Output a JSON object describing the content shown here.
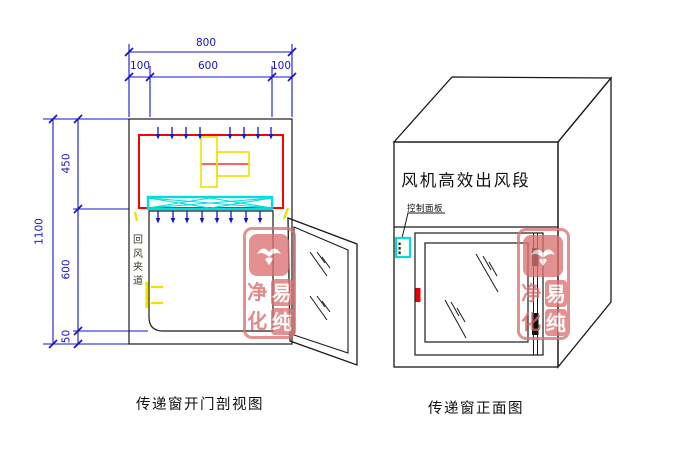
{
  "left_view": {
    "caption": "传递窗开门剖视图",
    "return_air_label": "回风夹道",
    "dimensions": {
      "overall_width": "800",
      "width_left": "100",
      "width_center": "600",
      "width_right": "100",
      "overall_height": "1100",
      "fan_section_height": "450",
      "chamber_height": "600",
      "base_height": "50"
    }
  },
  "right_view": {
    "caption": "传递窗正面图",
    "fan_section_label": "风机高效出风段",
    "control_panel_label": "控制面板"
  },
  "watermark": {
    "top_left_char": "净",
    "top_right_char": "易",
    "bottom_left_char": "化",
    "bottom_right_char": "纯"
  },
  "colors": {
    "dimension_blue": "#1414cc",
    "outline_black": "#1a1a1a",
    "fan_frame_red": "#ff0000",
    "filter_cyan": "#00dddd",
    "accent_yellow": "#f0e000",
    "stamp_rose": "#dd7272"
  }
}
